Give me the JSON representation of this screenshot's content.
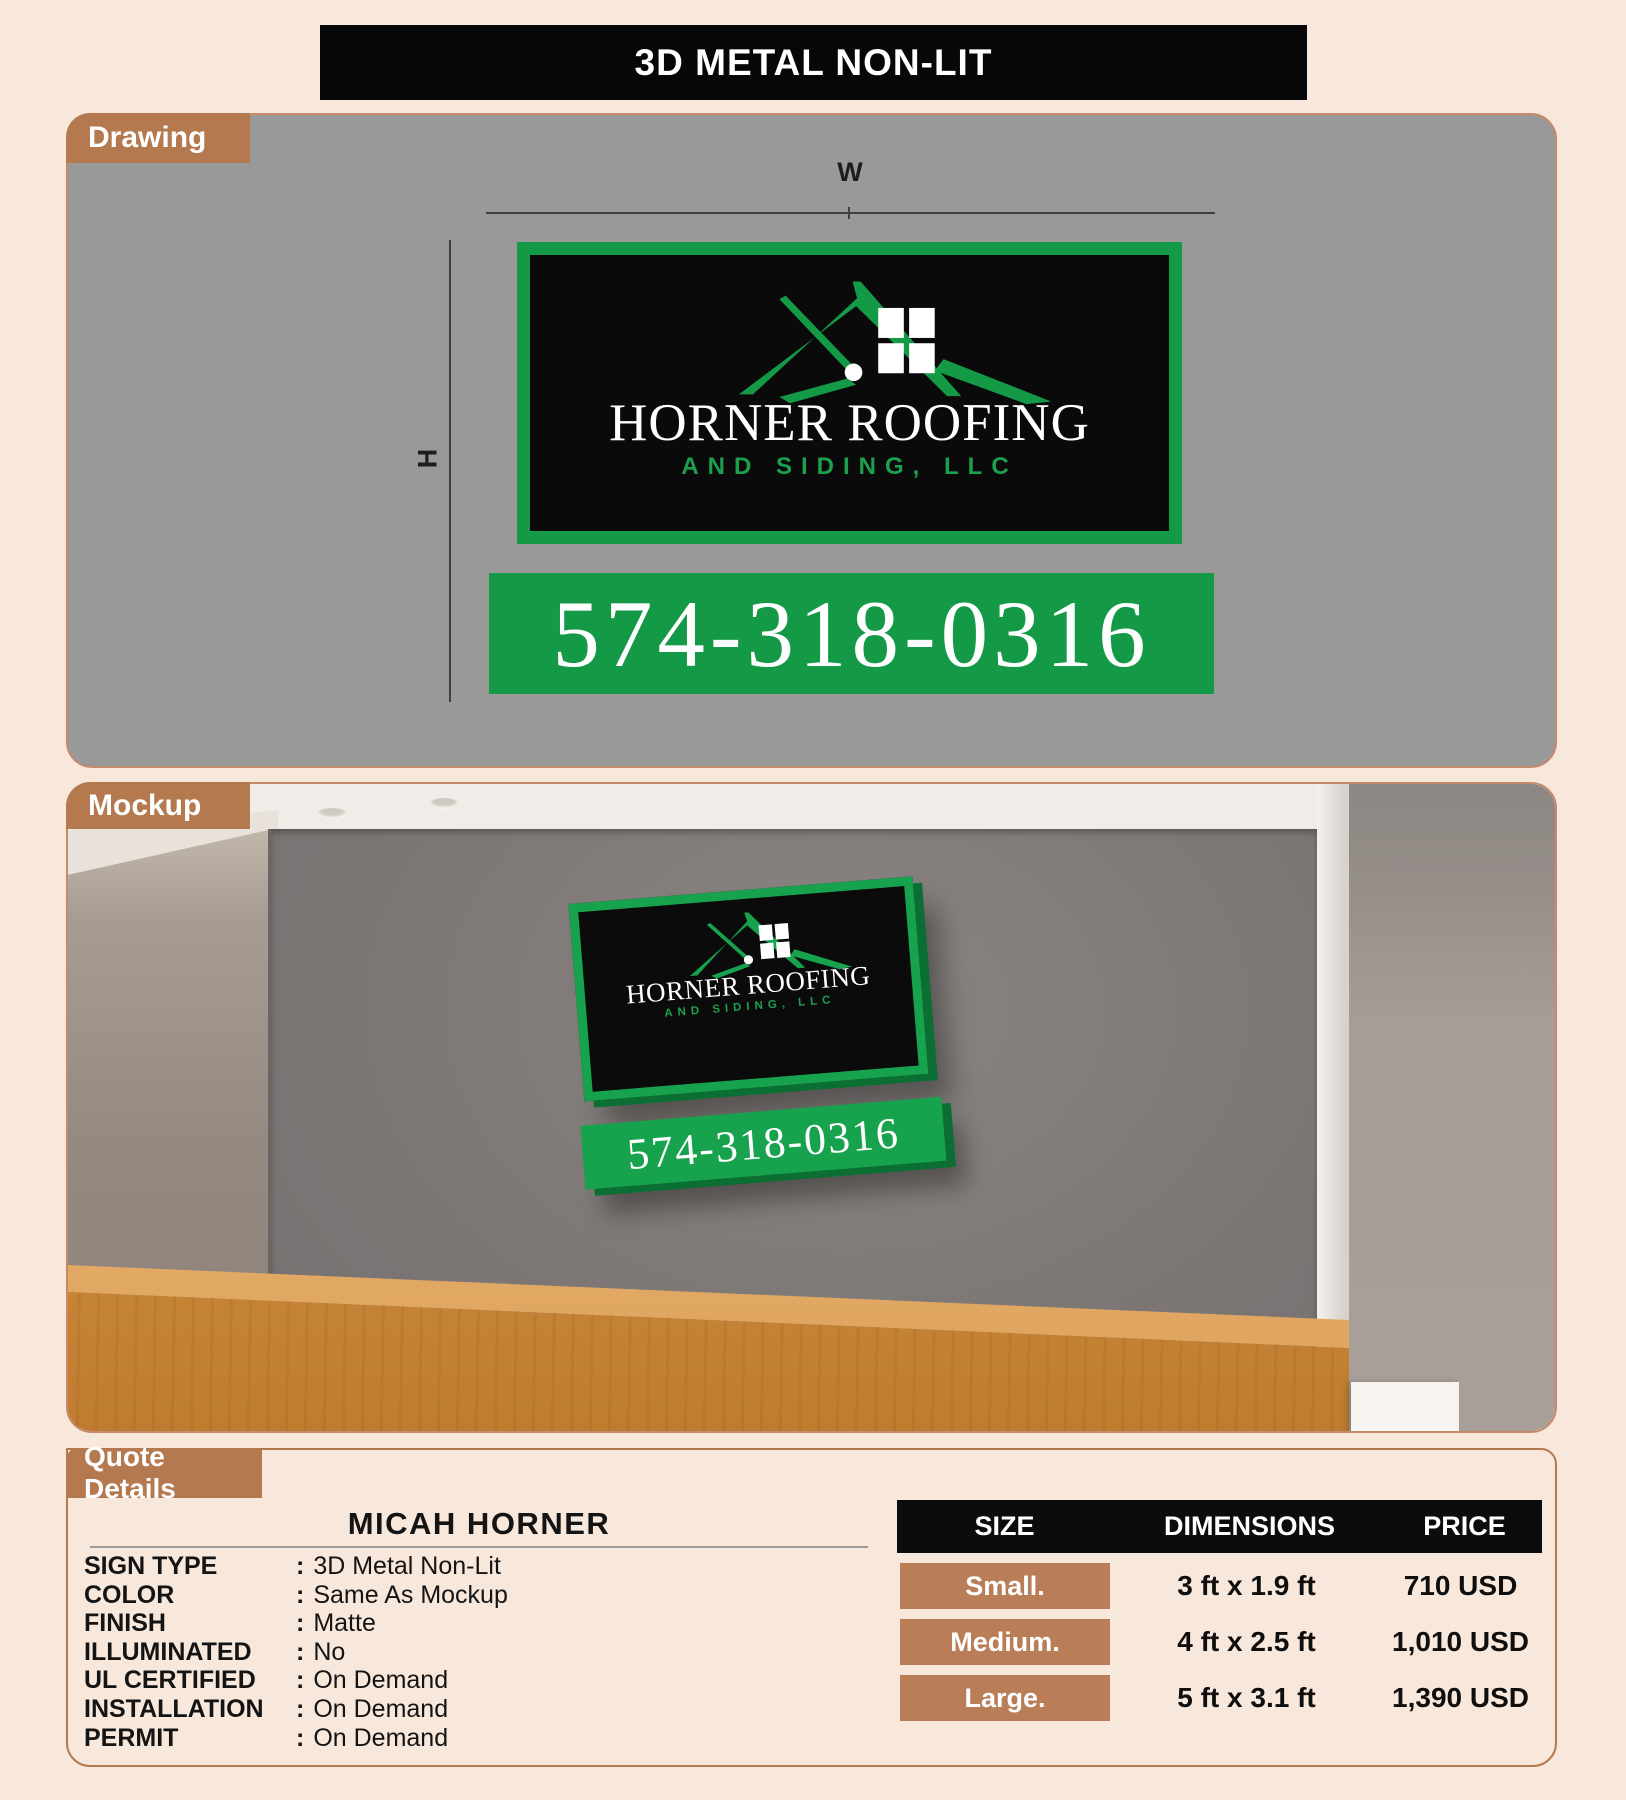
{
  "title": "3D METAL NON-LIT",
  "sections": {
    "drawing_label": "Drawing",
    "mockup_label": "Mockup",
    "quote_label": "Quote Details"
  },
  "dimensions": {
    "width_label": "W",
    "height_label": "H"
  },
  "sign": {
    "company": "HORNER ROOFING",
    "tagline": "AND SIDING, LLC",
    "phone": "574-318-0316"
  },
  "quote": {
    "customer": "MICAH HORNER",
    "separator": ":",
    "details": [
      {
        "label": "SIGN TYPE",
        "value": "3D Metal Non-Lit"
      },
      {
        "label": "COLOR",
        "value": "Same As Mockup"
      },
      {
        "label": "FINISH",
        "value": "Matte"
      },
      {
        "label": "ILLUMINATED",
        "value": "No"
      },
      {
        "label": "UL CERTIFIED",
        "value": "On Demand"
      },
      {
        "label": "INSTALLATION",
        "value": "On Demand"
      },
      {
        "label": "PERMIT",
        "value": "On Demand"
      }
    ],
    "table": {
      "headers": {
        "size": "SIZE",
        "dimensions": "DIMENSIONS",
        "price": "PRICE"
      },
      "rows": [
        {
          "size": "Small.",
          "dimensions": "3 ft x 1.9 ft",
          "price": "710 USD"
        },
        {
          "size": "Medium.",
          "dimensions": "4 ft x 2.5 ft",
          "price": "1,010 USD"
        },
        {
          "size": "Large.",
          "dimensions": "5 ft x 3.1 ft",
          "price": "1,390 USD"
        }
      ]
    }
  },
  "colors": {
    "accent_green": "#149a47",
    "accent_green_dark": "#0b6e33",
    "accent_brown": "#b5794f",
    "badge_brown": "#b97e57",
    "panel_gray": "#999999",
    "table_header_black": "#0c0c0c",
    "page_background": "#f8e7db"
  }
}
